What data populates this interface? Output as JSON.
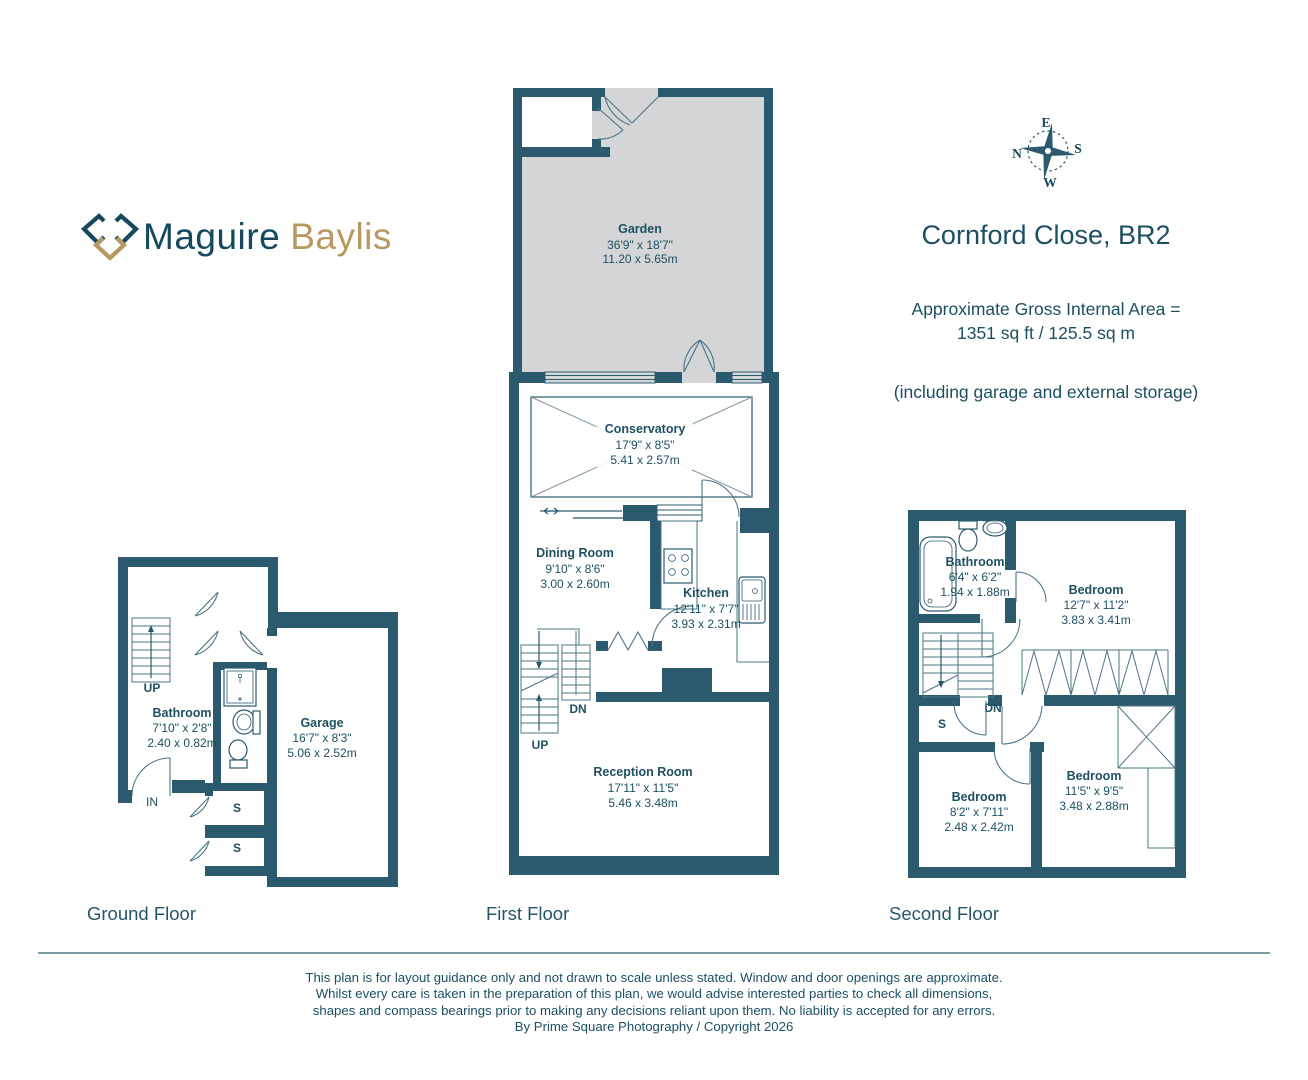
{
  "brand": {
    "word1": "Maguire",
    "word2": "Baylis"
  },
  "compass": {
    "n": "N",
    "e": "E",
    "s": "S",
    "w": "W"
  },
  "header": {
    "title": "Cornford Close, BR2",
    "area_line1": "Approximate Gross Internal Area =",
    "area_line2": "1351 sq ft / 125.5 sq m",
    "area_note": "(including garage and external storage)"
  },
  "colors": {
    "wall": "#2b5a6e",
    "gold": "#b7995f",
    "garden_fill": "#d3d5d6",
    "text": "#1d4f63"
  },
  "floors": {
    "ground": {
      "label": "Ground Floor",
      "bathroom": {
        "name": "Bathroom",
        "imperial": "7'10\" x 2'8\"",
        "metric": "2.40 x 0.82m"
      },
      "garage": {
        "name": "Garage",
        "imperial": "16'7\" x 8'3\"",
        "metric": "5.06 x 2.52m"
      },
      "up": "UP",
      "in": "IN",
      "s1": "S",
      "s2": "S"
    },
    "first": {
      "label": "First Floor",
      "garden": {
        "name": "Garden",
        "imperial": "36'9\" x 18'7\"",
        "metric": "11.20 x 5.65m"
      },
      "conservatory": {
        "name": "Conservatory",
        "imperial": "17'9\" x 8'5\"",
        "metric": "5.41 x 2.57m"
      },
      "dining": {
        "name": "Dining Room",
        "imperial": "9'10\" x 8'6\"",
        "metric": "3.00 x 2.60m"
      },
      "kitchen": {
        "name": "Kitchen",
        "imperial": "12'11\" x 7'7\"",
        "metric": "3.93 x 2.31m"
      },
      "reception": {
        "name": "Reception Room",
        "imperial": "17'11\" x 11'5\"",
        "metric": "5.46 x 3.48m"
      },
      "up": "UP",
      "dn": "DN"
    },
    "second": {
      "label": "Second Floor",
      "bathroom": {
        "name": "Bathroom",
        "imperial": "6'4\" x 6'2\"",
        "metric": "1.94 x 1.88m"
      },
      "bedroom1": {
        "name": "Bedroom",
        "imperial": "12'7\" x 11'2\"",
        "metric": "3.83 x 3.41m"
      },
      "bedroom2": {
        "name": "Bedroom",
        "imperial": "8'2\" x 7'11\"",
        "metric": "2.48 x 2.42m"
      },
      "bedroom3": {
        "name": "Bedroom",
        "imperial": "11'5\" x 9'5\"",
        "metric": "3.48 x 2.88m"
      },
      "dn": "DN",
      "s": "S"
    }
  },
  "footer": {
    "line1": "This plan is for layout guidance only and not drawn to scale unless stated. Window and door openings are approximate.",
    "line2": "Whilst every care is taken in the preparation of this plan, we would advise interested parties to check all dimensions,",
    "line3": "shapes and compass bearings prior to making any decisions reliant upon them. No liability is accepted for any errors.",
    "line4": "By Prime Square Photography / Copyright 2026"
  }
}
